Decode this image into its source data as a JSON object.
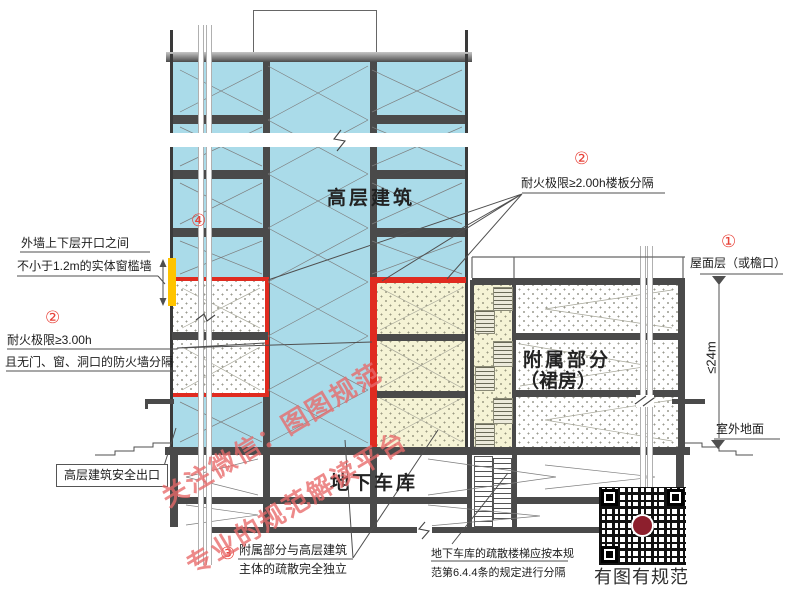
{
  "figure": {
    "labels": {
      "tower": "高层建筑",
      "podium_line1": "附属部分",
      "podium_line2": "（裙房）",
      "garage": "地下车库"
    },
    "callouts": {
      "roof": {
        "badge": "①",
        "text": "屋面层（或檐口）"
      },
      "floor_separation": {
        "badge": "②",
        "text": "耐火极限≥2.00h楼板分隔"
      },
      "fire_wall": {
        "badge": "②",
        "line1": "耐火极限≥3.00h",
        "line2": "且无门、窗、洞口的防火墙分隔"
      },
      "independent": {
        "badge": "③",
        "line1": "附属部分与高层建筑",
        "line2": "主体的疏散完全独立"
      },
      "spandrel": {
        "badge": "④",
        "line1": "外墙上下层开口之间",
        "line2": "不小于1.2m的实体窗槛墙"
      },
      "tower_exit": "高层建筑安全出口",
      "garage_stair": {
        "line1": "地下车库的疏散楼梯应按本规",
        "line2": "范第6.4.4条的规定进行分隔"
      },
      "height_dim": "≤24m",
      "outdoor_ground": "室外地面"
    },
    "watermark": {
      "line1": "关注微信：图图规范",
      "line2": "专业的规范解读平台"
    },
    "qr_caption": "有图有规范",
    "colors": {
      "tower_fill": "#aadbe9",
      "podium_fill": "#f5f3d5",
      "slab": "#4a4a4a",
      "fire_red": "#e02b20",
      "spandrel_yellow": "#ffc400",
      "badge_red": "#e8433a",
      "watermark": "#e86969"
    }
  }
}
